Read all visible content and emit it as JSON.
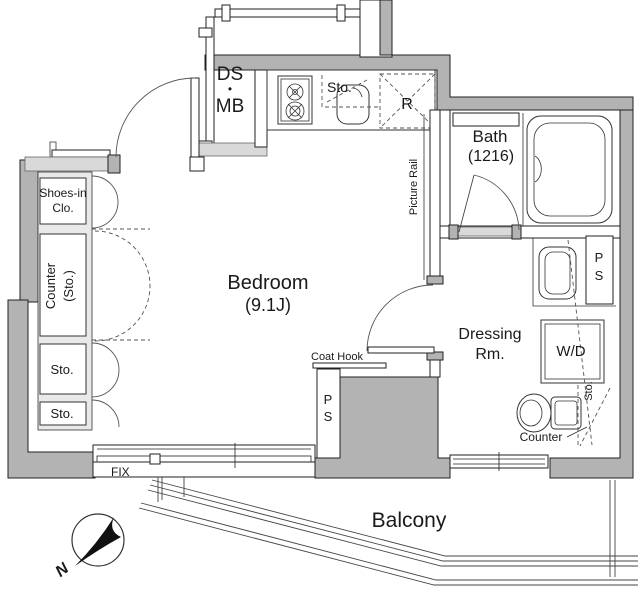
{
  "colors": {
    "wall": "#b3b3b3",
    "wall_light": "#d9d9d9",
    "line": "#1a1a1a"
  },
  "corridor": {
    "shaft_line1": "DS",
    "shaft_dot": "•",
    "shaft_line2": "MB"
  },
  "kitchen": {
    "storage": "Sto.",
    "refrigerator": "R"
  },
  "bath": {
    "name": "Bath",
    "size": "(1216)"
  },
  "bedroom": {
    "name": "Bedroom",
    "size": "(9.1J)",
    "picture_rail": "Picture Rail",
    "coat_hook": "Coat Hook",
    "pipe_space_p": "P",
    "pipe_space_s": "S",
    "window": "FIX"
  },
  "left_storage": {
    "shoes_line1": "Shoes-in",
    "shoes_line2": "Clo.",
    "counter_line1": "Counter",
    "counter_line2": "(Sto.)",
    "storage_top": "Sto.",
    "storage_bottom": "Sto."
  },
  "dressing_room": {
    "name_line1": "Dressing",
    "name_line2": "Rm.",
    "washer_dryer": "W/D",
    "pipe_space_p": "P",
    "pipe_space_s": "S",
    "storage": "Sto.",
    "counter": "Counter"
  },
  "balcony": {
    "name": "Balcony"
  },
  "compass": {
    "north": "N"
  }
}
